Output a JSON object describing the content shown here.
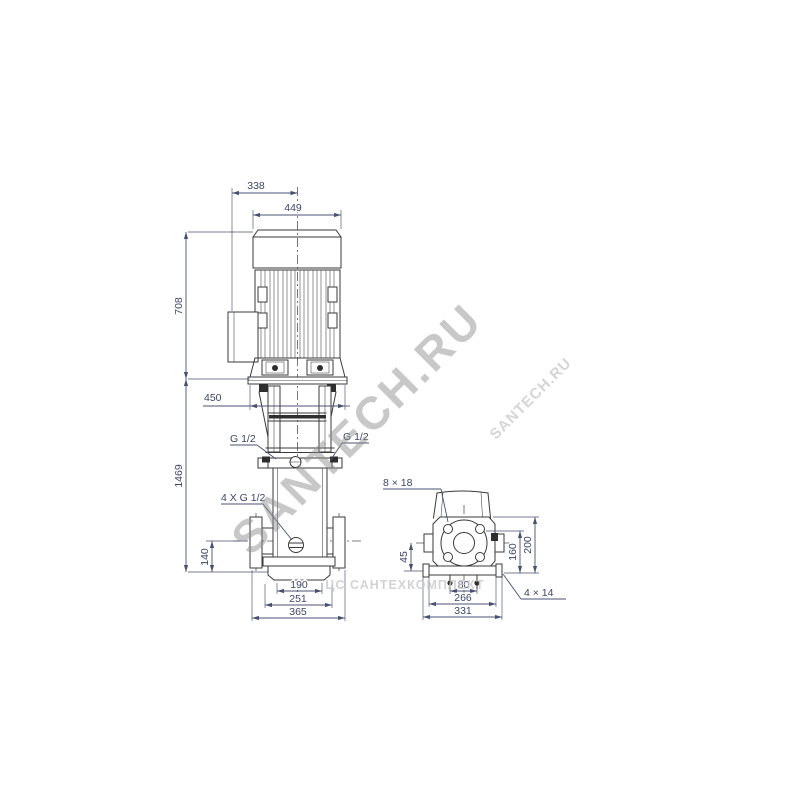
{
  "drawing": {
    "kind": "pump dimensional drawing",
    "units": "mm",
    "views": [
      "front elevation",
      "side elevation with base plan"
    ]
  },
  "dims": {
    "front": {
      "d338": "338",
      "d449": "449",
      "d708": "708",
      "d450": "450",
      "d1469": "1469",
      "d140": "140",
      "d190": "190",
      "d251": "251",
      "d365": "365",
      "g_left": "G 1/2",
      "g_right": "G 1/2",
      "drain": "4 X G 1/2"
    },
    "side": {
      "slot": "8 × 18",
      "d45": "45",
      "d160": "160",
      "d200": "200",
      "d80": "80",
      "d266": "266",
      "d331": "331",
      "holes": "4 × 14"
    }
  },
  "watermarks": {
    "main": "SANTECH.RU",
    "small": "SANTECH.RU",
    "band": "ЦС САНТЕХКОМПЛЕКТ"
  },
  "colors": {
    "line": "#3a3a3a",
    "dimension": "#3d4468",
    "watermark": "#8e8e8e",
    "background": "#ffffff"
  }
}
